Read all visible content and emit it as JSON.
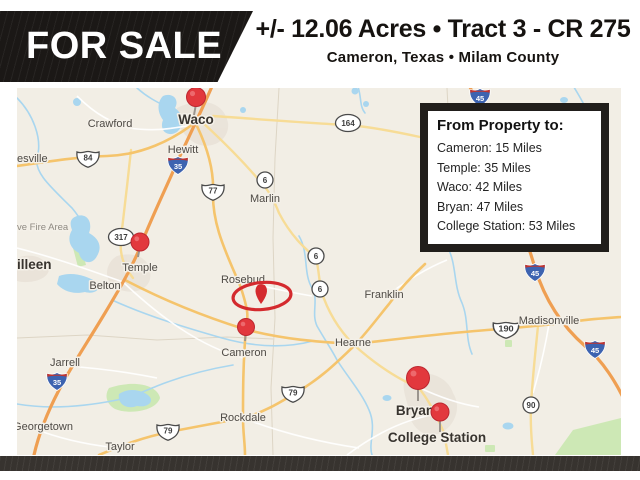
{
  "header": {
    "badge": "FOR SALE",
    "title": "+/- 12.06 Acres • Tract 3 - CR 275",
    "subtitle": "Cameron, Texas • Milam County"
  },
  "info_box": {
    "title": "From Property to:",
    "lines": [
      "Cameron: 15 Miles",
      "Temple: 35 Miles",
      "Waco: 42 Miles",
      "Bryan: 47 Miles",
      "College Station: 53 Miles"
    ]
  },
  "map": {
    "city_labels": [
      "esville",
      "Crawford",
      "Waco",
      "Hewitt",
      "Marlin",
      "ve Fire Area",
      "illeen",
      "Temple",
      "Belton",
      "Rosebud",
      "Franklin",
      "Hearne",
      "Madisonville",
      "Jarrell",
      "Cameron",
      "Rockdale",
      "Georgetown",
      "Taylor",
      "Bryan",
      "College Station"
    ],
    "shield_labels": [
      "84",
      "35",
      "77",
      "164",
      "6",
      "317",
      "6",
      "6",
      "190",
      "45",
      "45",
      "79",
      "79",
      "90",
      "35",
      "45"
    ],
    "colors": {
      "marker_red": "#e2383d",
      "property_red": "#d42a2e",
      "water": "#a9d6ef",
      "interstate_road": "#ef9f52",
      "us_road": "#f5c46c",
      "state_road": "#f7dc96",
      "map_background": "#f2eee5",
      "banner_black": "#1b1816"
    }
  }
}
